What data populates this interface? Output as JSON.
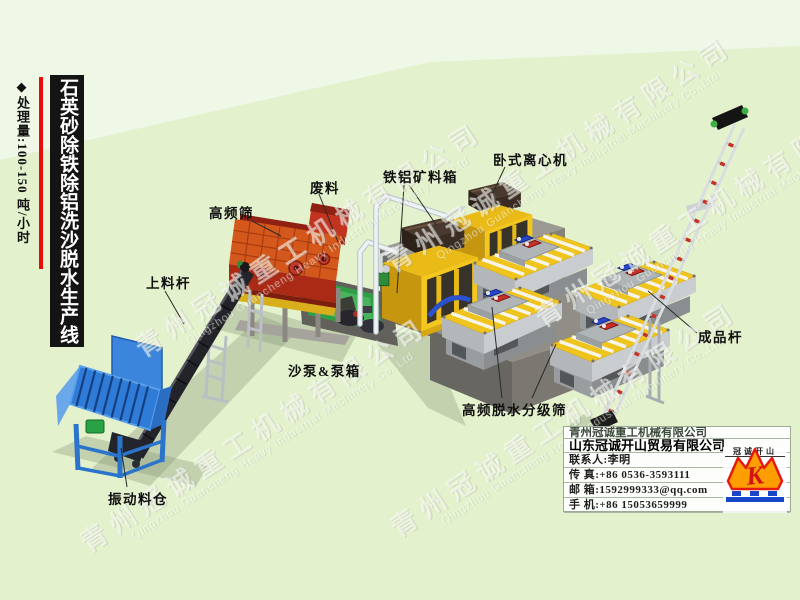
{
  "poster": {
    "title_vertical": "石英砂除铁除铝洗沙脱水生产线",
    "capacity_note": "◆处理量:100-150 吨/小时"
  },
  "equipment_labels": {
    "feed_conveyor": "上料杆",
    "high_frequency_screen": "高频筛",
    "waste": "废料",
    "iron_aluminum_ore_box": "铁铝矿料箱",
    "horizontal_centrifuge": "卧式离心机",
    "sand_pump_and_pump_box": "沙泵&泵箱",
    "dewatering_classifying_screen": "高频脱水分级筛",
    "finished_product_conveyor": "成品杆",
    "vibrating_hopper": "振动料仓"
  },
  "watermark": {
    "cn": "青州冠诚重工机械有限公司",
    "en": "Qingzhou Guancheng Heavy Industrial Machinery Co.,Ltd"
  },
  "contact_card": {
    "company_1": "青州冠诚重工机械有限公司",
    "company_2": "山东冠诚开山贸易有限公司",
    "contact_person": "联系人:李明",
    "fax": "传  真:+86 0536-3593111",
    "email": "邮  箱:1592999333@qq.com",
    "mobile": "手  机:+86 15053659999",
    "logo_monogram": "K",
    "logo_caption": "冠诚开山"
  },
  "colors": {
    "background": "#e7f3d5",
    "accent_red": "#ec0a0a",
    "title_bg": "#141414",
    "crown_orange": "#ff9e00",
    "crown_red": "#e6190f",
    "logo_blue": "#1746c8"
  }
}
